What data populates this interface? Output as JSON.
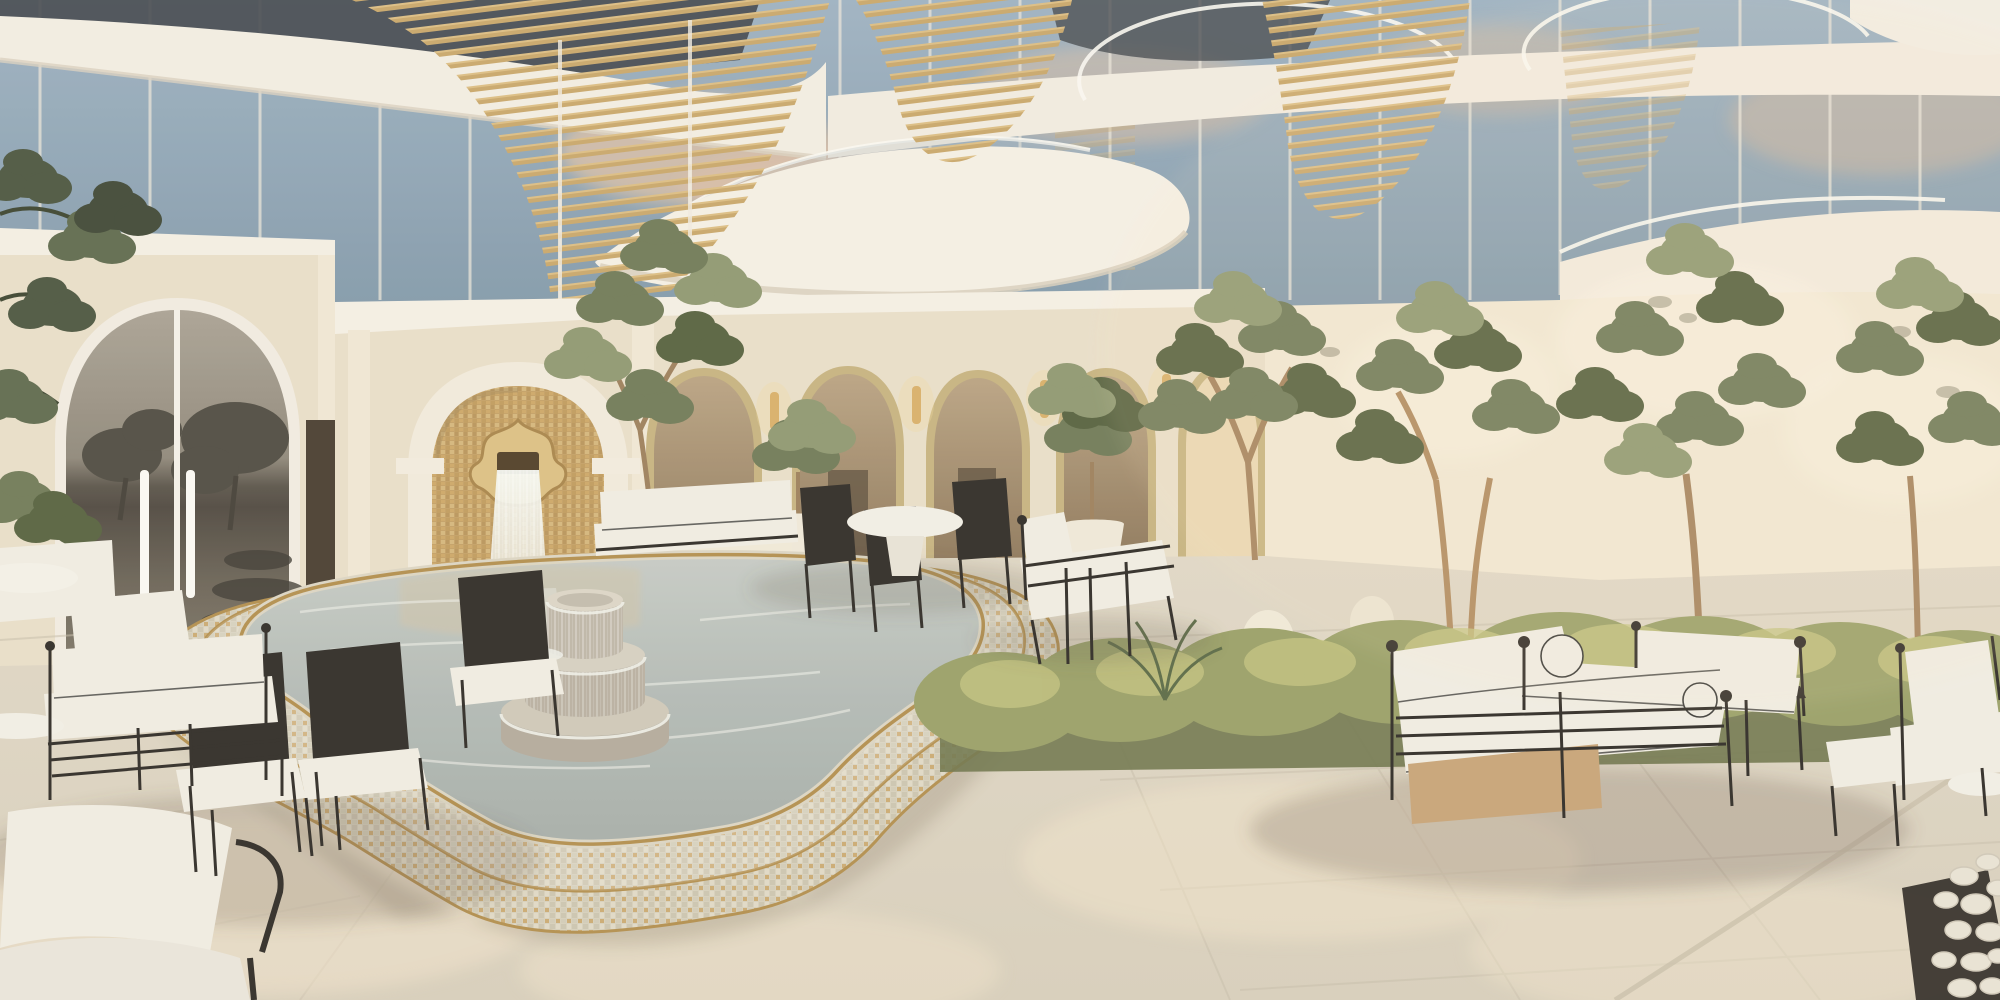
{
  "scene": {
    "description": "Sunlit luxury courtyard rendering: curved glass residence with gold louver screens above a Moorish gold-mosaic waterfall fountain, a scalloped tiered mosaic pool, an arched arcade with olive trees, hedges and white iron-framed lounge furniture on travertine paving",
    "objects": {
      "glass_facade": "curved glass curtain wall reflecting sky and clouds",
      "curved_balconies": "organic white balcony slabs with curved glass railings",
      "gold_louver_screens": "wavy cascades of horizontal gold slats on the facade",
      "left_arched_door": "arched glass door reflecting a dusk sea horizon and trees",
      "fountain_wall": "cream arch niche lined with gold mosaic",
      "moorish_spout": "cusped gold medallion spout",
      "waterfall": "sheet of water falling from the spout into the pool",
      "tiered_fountain": "three-tier round stone fountain overflowing with water",
      "mosaic_pool": "scalloped two-step pool faced in white-gold mosaic with gold trim",
      "arcade": "row of round arches trimmed in gold mosaic",
      "wall_sconces": "cylindrical brass wall lights on arcade pilasters",
      "olive_trees": "olive trees in beds and white urns",
      "hedges": "low clipped hedges along the right wall",
      "lounge_furniture": "white cushioned sofas and chairs with thin black iron frames",
      "dining_set": "round white pedestal table with black chairs",
      "floor": "large-format travertine tiles with warm sun patches",
      "pebble_border": "white pebble strip at the lower right edge"
    }
  },
  "palette": {
    "glass_sky": "#94aabc",
    "glass_dark": "#3e444b",
    "cloud_warm": "#dcc0a6",
    "fascia": "#f3eee3",
    "stucco": "#e9dfca",
    "stucco_light": "#f1e8d4",
    "stucco_shadow": "#d6c9b1",
    "gold_louver": "#c9a76b",
    "gold_louver_light": "#e4c88f",
    "gold_mosaic": "#c3a066",
    "gold_trim": "#b28e4e",
    "gold_sconce": "#d9b06a",
    "arch_interior": "#a8906c",
    "arch_interior_bright": "#ead8b4",
    "water": "#b2bab5",
    "pool_tile": "#d7d0bd",
    "water_sparkle": "#edefe8",
    "floor": "#ded6c5",
    "floor_light": "#efe5d0",
    "floor_grout": "#c7beac",
    "foliage_dark": "#55613f",
    "foliage_mid": "#6f7a58",
    "foliage_light": "#8e9871",
    "trunk": "#a4825d",
    "hedge": "#99a068",
    "hedge_light": "#c5c581",
    "frame_black": "#2e2a26",
    "cushion": "#f0ede4",
    "cushion_shadow": "#d8d3c6",
    "wood_base": "#c8a478",
    "reflection_sky": "#a39c8e",
    "reflection_sea": "#564f46",
    "pebble": "#e9e3d5"
  }
}
